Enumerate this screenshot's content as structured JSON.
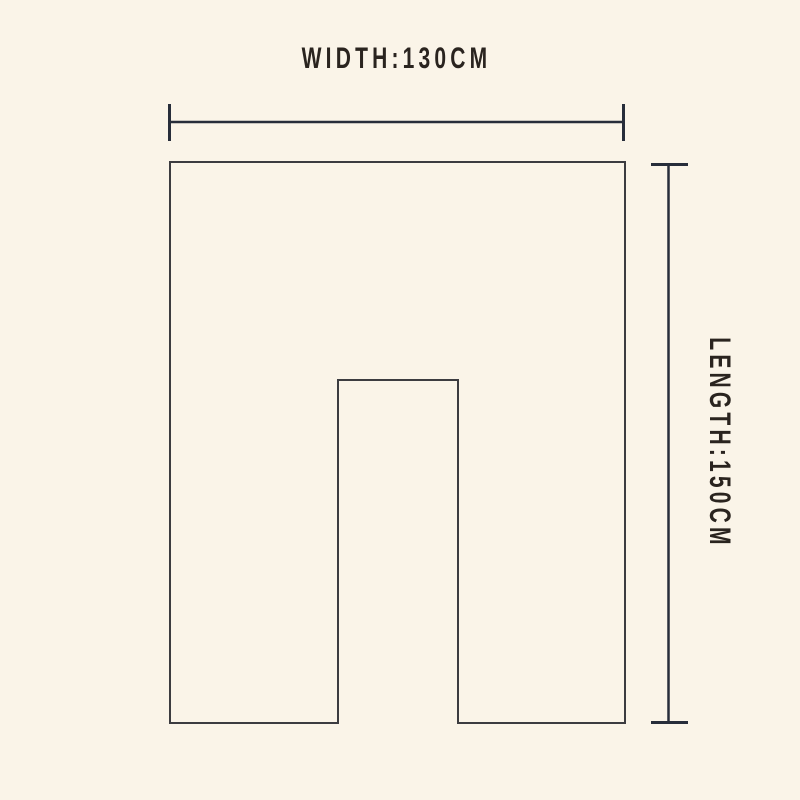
{
  "colors": {
    "background": "#faf4e8",
    "line": "#272d3a",
    "outline": "#3c3c40",
    "text": "#2a241f"
  },
  "diagram": {
    "title": "Garment / cover dimension diagram",
    "width_label": "WIDTH:130CM",
    "length_label": "LENGTH:150CM"
  }
}
